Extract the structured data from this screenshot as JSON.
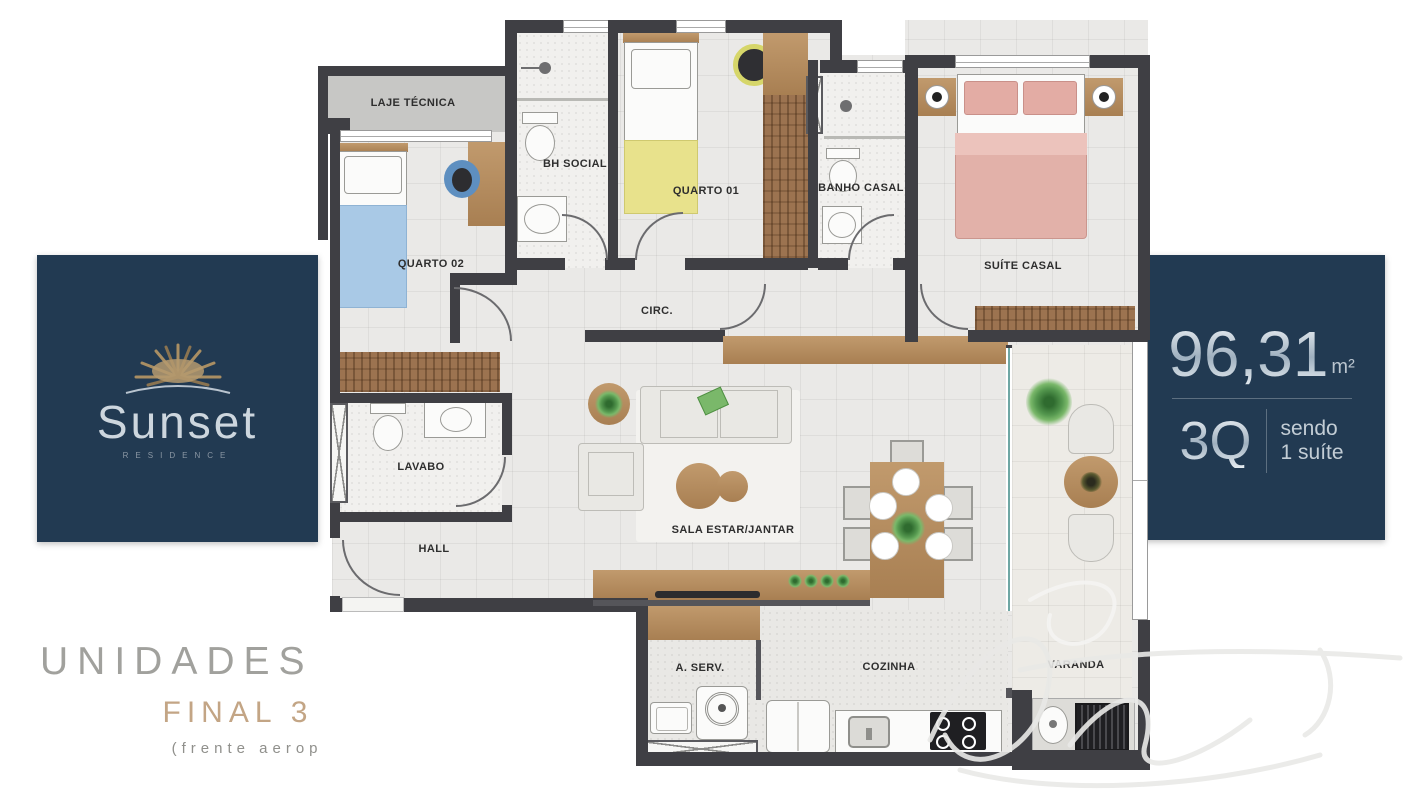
{
  "brand": {
    "name": "Sunset",
    "residence": "RESIDENCE"
  },
  "right_panel": {
    "area": "96,31",
    "area_unit": "m²",
    "rooms_count": "3Q",
    "note_line1": "sendo",
    "note_line2": "1 suíte"
  },
  "footer": {
    "line1": "UNIDADES NASCENTE",
    "line2": "FINAL 3 e 4",
    "line3": "(frente aeroporto)"
  },
  "rooms": [
    {
      "id": "laje-tecnica",
      "label": "LAJE TÉCNICA"
    },
    {
      "id": "quarto-02",
      "label": "QUARTO 02"
    },
    {
      "id": "bh-social",
      "label": "BH SOCIAL"
    },
    {
      "id": "quarto-01",
      "label": "QUARTO 01"
    },
    {
      "id": "banho-casal",
      "label": "BANHO CASAL"
    },
    {
      "id": "suite-casal",
      "label": "SUÍTE CASAL"
    },
    {
      "id": "circ",
      "label": "CIRC."
    },
    {
      "id": "lavabo",
      "label": "LAVABO"
    },
    {
      "id": "hall",
      "label": "HALL"
    },
    {
      "id": "sala",
      "label": "SALA ESTAR/JANTAR"
    },
    {
      "id": "a-serv",
      "label": "A. SERV."
    },
    {
      "id": "cozinha",
      "label": "COZINHA"
    },
    {
      "id": "varanda",
      "label": "VARANDA"
    }
  ],
  "colors": {
    "navy": "#223a52",
    "wall": "#3f3f44",
    "wood": "#ab8257",
    "tan_accent": "#c3a585",
    "bed_blue": "#a9c9e6",
    "bed_yellow": "#e8e28c",
    "bed_pink": "#e2b1a9"
  },
  "watermark": {
    "type": "signature",
    "color": "#e9e9e7"
  }
}
